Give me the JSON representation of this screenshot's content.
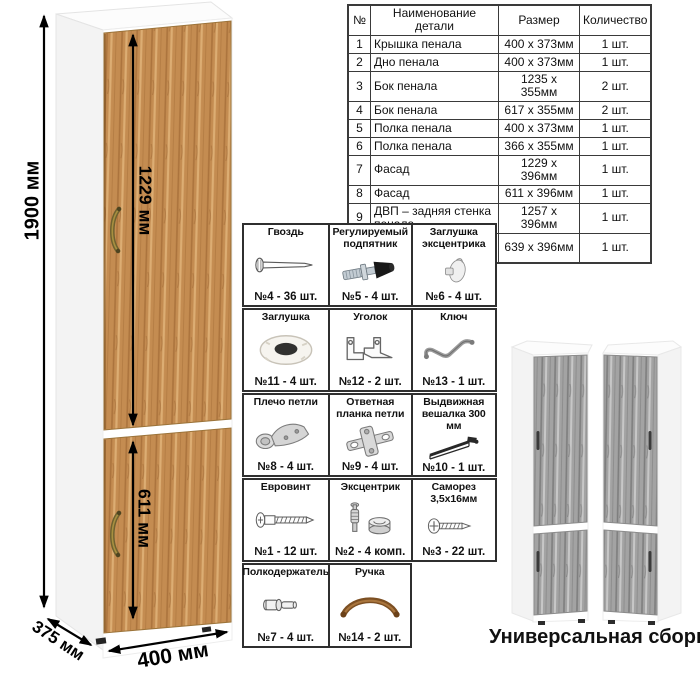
{
  "cabinet_diagram": {
    "dim_height": "1900 мм",
    "dim_top_door": "1229 мм",
    "dim_bottom_door": "611 мм",
    "dim_depth": "375 мм",
    "dim_width": "400 мм",
    "colors": {
      "wood": "#c48c51",
      "gray_wood": "#a3a3a3",
      "carcass": "#ffffff",
      "arrow": "#000000"
    }
  },
  "parts_table": {
    "headers": [
      "№",
      "Наименование детали",
      "Размер",
      "Количество"
    ],
    "rows": [
      [
        "1",
        "Крышка пенала",
        "400 х 373мм",
        "1 шт."
      ],
      [
        "2",
        "Дно пенала",
        "400 х 373мм",
        "1 шт."
      ],
      [
        "3",
        "Бок пенала",
        "1235 х 355мм",
        "2 шт."
      ],
      [
        "4",
        "Бок пенала",
        "617 х 355мм",
        "2 шт."
      ],
      [
        "5",
        "Полка пенала",
        "400 х 373мм",
        "1 шт."
      ],
      [
        "6",
        "Полка пенала",
        "366 х 355мм",
        "1 шт."
      ],
      [
        "7",
        "Фасад",
        "1229 х 396мм",
        "1 шт."
      ],
      [
        "8",
        "Фасад",
        "611 х 396мм",
        "1 шт."
      ],
      [
        "9",
        "ДВП – задняя стенка пенала",
        "1257 х 396мм",
        "1 шт."
      ],
      [
        "10",
        "ДВП – задняя стенка пенала",
        "639 х 396мм",
        "1 шт."
      ]
    ]
  },
  "hardware_grid": {
    "items": [
      {
        "name": "Гвоздь",
        "count": "№4 - 36 шт.",
        "icon": "nail-icon"
      },
      {
        "name": "Регулируемый подпятник",
        "count": "№5 - 4 шт.",
        "icon": "adjustable-foot-icon"
      },
      {
        "name": "Заглушка эксцентрика",
        "count": "№6 - 4 шт.",
        "icon": "cam-cover-icon"
      },
      {
        "name": "Заглушка",
        "count": "№11 - 4 шт.",
        "icon": "cap-icon"
      },
      {
        "name": "Уголок",
        "count": "№12 - 2 шт.",
        "icon": "corner-bracket-icon"
      },
      {
        "name": "Ключ",
        "count": "№13 - 1 шт.",
        "icon": "key-icon"
      },
      {
        "name": "Плечо петли",
        "count": "№8 - 4 шт.",
        "icon": "hinge-arm-icon"
      },
      {
        "name": "Ответная планка петли",
        "count": "№9 - 4 шт.",
        "icon": "hinge-plate-icon"
      },
      {
        "name": "Выдвижная вешалка 300 мм",
        "count": "№10 - 1 шт.",
        "icon": "pullout-hanger-icon"
      },
      {
        "name": "Евровинт",
        "count": "№1 - 12 шт.",
        "icon": "euro-screw-icon"
      },
      {
        "name": "Эксцентрик",
        "count": "№2 - 4 комп.",
        "icon": "cam-lock-icon"
      },
      {
        "name": "Саморез 3,5х16мм",
        "count": "№3 - 22 шт.",
        "icon": "screw-icon"
      },
      {
        "name": "Полкодержатель",
        "count": "№7 - 4 шт.",
        "icon": "shelf-pin-icon"
      },
      {
        "name": "Ручка",
        "count": "№14 - 2 шт.",
        "icon": "handle-icon"
      }
    ]
  },
  "variants": {
    "caption": "Универсальная сборка."
  }
}
